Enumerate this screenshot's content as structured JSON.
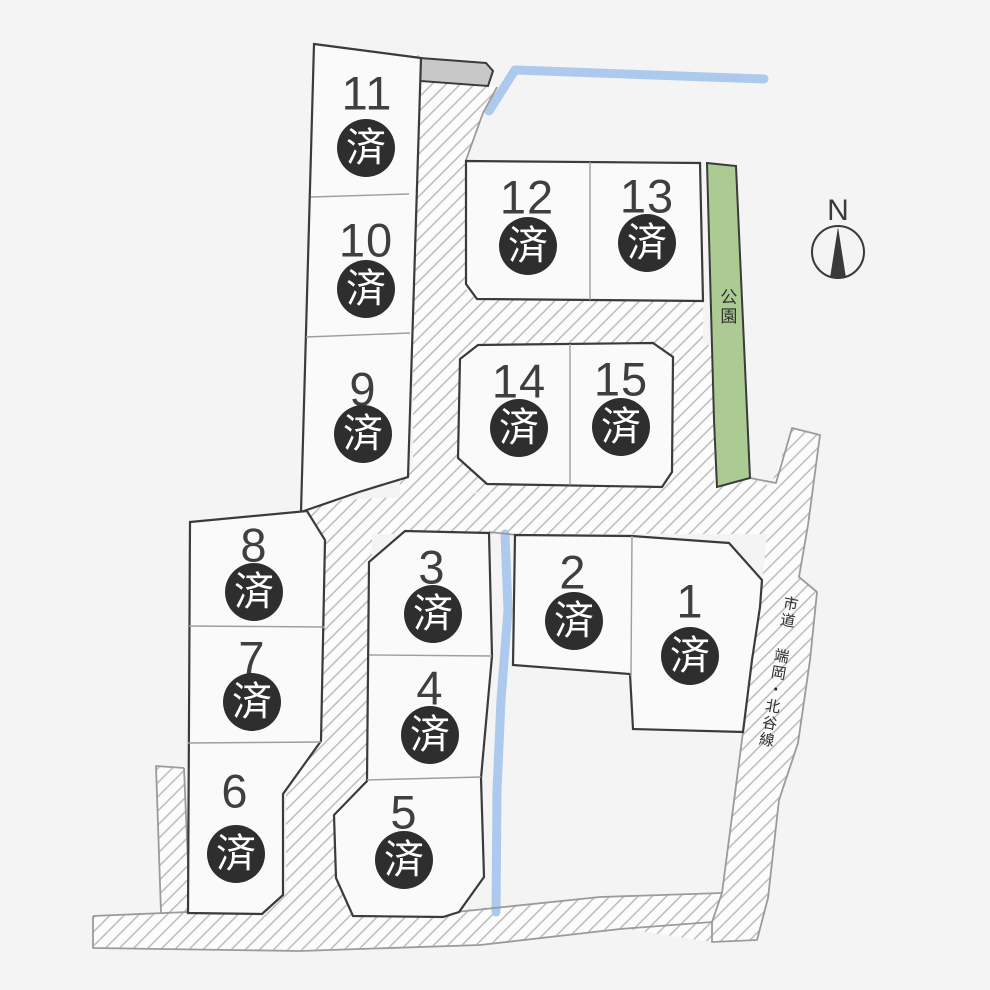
{
  "lots": [
    {
      "number": "1",
      "status": "済"
    },
    {
      "number": "2",
      "status": "済"
    },
    {
      "number": "3",
      "status": "済"
    },
    {
      "number": "4",
      "status": "済"
    },
    {
      "number": "5",
      "status": "済"
    },
    {
      "number": "6",
      "status": "済"
    },
    {
      "number": "7",
      "status": "済"
    },
    {
      "number": "8",
      "status": "済"
    },
    {
      "number": "9",
      "status": "済"
    },
    {
      "number": "10",
      "status": "済"
    },
    {
      "number": "11",
      "status": "済"
    },
    {
      "number": "12",
      "status": "済"
    },
    {
      "number": "13",
      "status": "済"
    },
    {
      "number": "14",
      "status": "済"
    },
    {
      "number": "15",
      "status": "済"
    }
  ],
  "labels": {
    "park": "公園",
    "road_name": "市道 端岡・北谷線",
    "compass_north": "N"
  },
  "colors": {
    "background": "#f4f4f4",
    "lot_fill": "#fafafa",
    "lot_border": "#3b3b3b",
    "hatch_line": "#b7b7b7",
    "road_edge": "#9b9b9b",
    "park_fill": "#abcb93",
    "stream": "#adc9ee",
    "sold_badge_bg": "#2e2e2e",
    "sold_badge_text": "#ffffff",
    "paved_strip_gray": "#c8c8c8"
  }
}
